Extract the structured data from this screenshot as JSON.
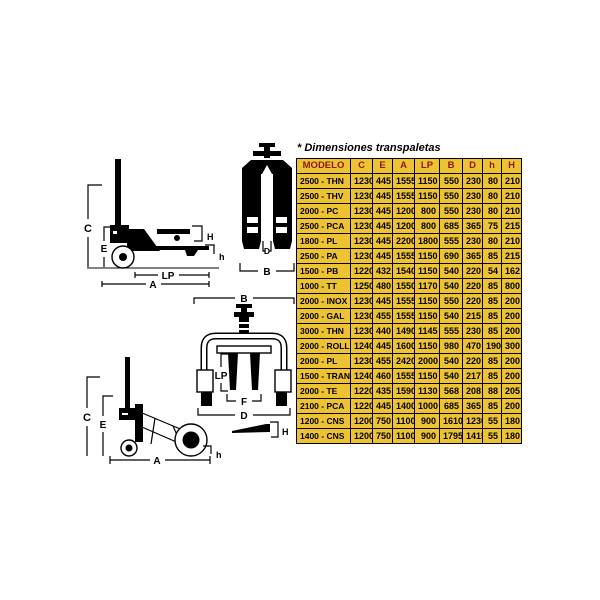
{
  "panel": {
    "title": "* Dimensiones transpaletas"
  },
  "table": {
    "headers": [
      "MODELO",
      "C",
      "E",
      "A",
      "LP",
      "B",
      "D",
      "h",
      "H"
    ],
    "rows": [
      [
        "2500 - THN",
        "1230",
        "445",
        "1555",
        "1150",
        "550",
        "230",
        "80",
        "210"
      ],
      [
        "2500 - THV",
        "1230",
        "445",
        "1555",
        "1150",
        "550",
        "230",
        "80",
        "210"
      ],
      [
        "2000 - PC",
        "1230",
        "445",
        "1200",
        "800",
        "550",
        "230",
        "80",
        "210"
      ],
      [
        "2500 - PCA",
        "1230",
        "445",
        "1200",
        "800",
        "685",
        "365",
        "75",
        "215"
      ],
      [
        "1800 - PL",
        "1230",
        "445",
        "2200",
        "1800",
        "555",
        "230",
        "80",
        "210"
      ],
      [
        "2500 - PA",
        "1230",
        "445",
        "1555",
        "1150",
        "690",
        "365",
        "85",
        "215"
      ],
      [
        "1500 - PB",
        "1220",
        "432",
        "1540",
        "1150",
        "540",
        "220",
        "54",
        "162"
      ],
      [
        "1000 - TT",
        "1250",
        "480",
        "1550",
        "1170",
        "540",
        "220",
        "85",
        "800"
      ],
      [
        "2000 - INOX",
        "1230",
        "445",
        "1555",
        "1150",
        "550",
        "220",
        "85",
        "200"
      ],
      [
        "2000 - GAL",
        "1230",
        "455",
        "1555",
        "1150",
        "540",
        "215",
        "85",
        "200"
      ],
      [
        "3000 - THN",
        "1230",
        "440",
        "1490",
        "1145",
        "555",
        "230",
        "85",
        "200"
      ],
      [
        "2000 - ROLL",
        "1240",
        "445",
        "1600",
        "1150",
        "980",
        "470",
        "190",
        "300"
      ],
      [
        "2000 - PL",
        "1230",
        "455",
        "2420",
        "2000",
        "540",
        "220",
        "85",
        "200"
      ],
      [
        "1500 - TRANS",
        "1240",
        "460",
        "1555",
        "1150",
        "540",
        "217",
        "85",
        "200"
      ],
      [
        "2000 - TE",
        "1220",
        "435",
        "1590",
        "1130",
        "568",
        "208",
        "88",
        "205"
      ],
      [
        "2100 - PCA",
        "1220",
        "445",
        "1400",
        "1000",
        "685",
        "365",
        "85",
        "200"
      ],
      [
        "1200 - CNS",
        "1200",
        "750",
        "1100",
        "900",
        "1610",
        "1230",
        "55",
        "180"
      ],
      [
        "1400 - CNS",
        "1200",
        "750",
        "1100",
        "900",
        "1795",
        "1415",
        "55",
        "180"
      ]
    ]
  },
  "diagram_labels": {
    "side_view": {
      "C": "C",
      "E": "E",
      "H": "H",
      "h": "h",
      "LP": "LP",
      "A": "A"
    },
    "top_view": {
      "D": "D",
      "B": "B"
    },
    "front_view": {
      "B": "B",
      "LP": "LP",
      "F": "F",
      "D": "D"
    },
    "lift_view": {
      "C": "C",
      "E": "E",
      "h": "h",
      "A": "A"
    },
    "fork_height": {
      "H": "H"
    }
  },
  "colors": {
    "table_bg": "#edc233",
    "header_text": "#8b1a1a",
    "ink": "#000000",
    "paper": "#ffffff"
  }
}
